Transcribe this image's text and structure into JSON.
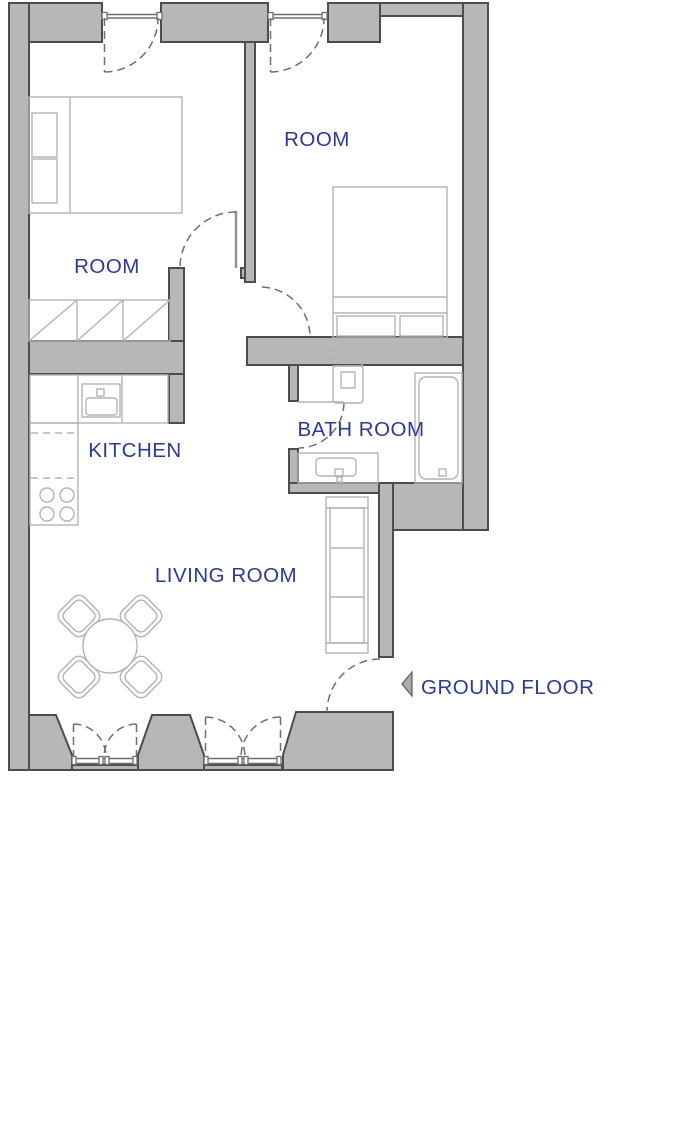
{
  "plan": {
    "labels": {
      "room_left": "ROOM",
      "room_right": "ROOM",
      "kitchen": "KITCHEN",
      "bathroom": "BATH ROOM",
      "living_room": "LIVING ROOM",
      "floor_title": "GROUND FLOOR"
    },
    "colors": {
      "background": "#ffffff",
      "wall_fill": "#b7b7b7",
      "wall_outline": "#4d4d4d",
      "furniture_line": "#b3b3b3",
      "frame_line": "#6e6e6e",
      "door_dash": "#6f6f6f",
      "label_text": "#2b3a94",
      "arrow_fill": "#ababab"
    }
  }
}
